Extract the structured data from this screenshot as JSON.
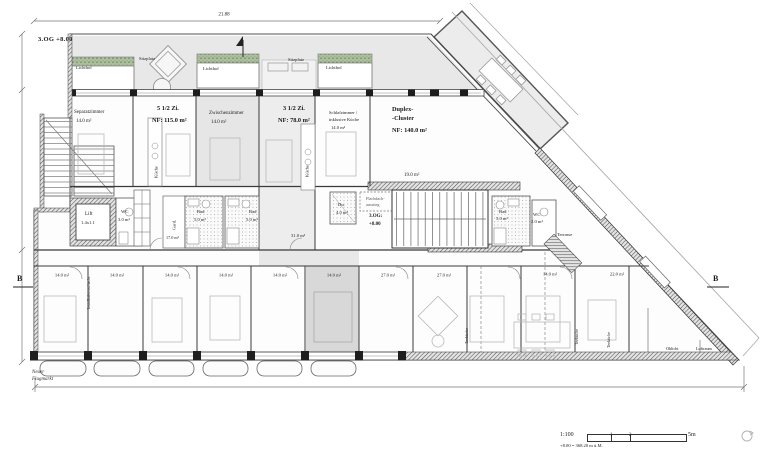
{
  "header": {
    "floor_label": "3.OG  +8.00"
  },
  "dimensions": {
    "top_width": "21.88"
  },
  "section_markers": {
    "left": "B",
    "right": "B"
  },
  "street": {
    "line1": "Neuer",
    "line2": "Flugmarkt"
  },
  "apartments": [
    {
      "name": "5 1/2 Zi.",
      "area": "NF: 115.0 m²"
    },
    {
      "name": "3 1/2 Zi.",
      "area": "NF: 78.0 m²"
    },
    {
      "name_line1": "Duplex-",
      "name_line2": "-Cluster",
      "area": "NF: 140.0 m²"
    }
  ],
  "rooms": {
    "separatzimmer": {
      "name": "Separatzimmer",
      "area": "14.0 m²"
    },
    "zwischenzimmer": {
      "name": "Zwischenzimmer",
      "area": "14.0 m²"
    },
    "schlafzimmer": {
      "name_line1": "Schlafzimmer /",
      "name_line2": "inklusive Küche",
      "area": "14.0 m²"
    },
    "room_19": {
      "area": "19.0 m²"
    },
    "hall_31": {
      "area": "31.0 m²"
    },
    "gard": {
      "name": "Gard.",
      "area": "17.0 m²"
    },
    "lift": {
      "name": "Lift",
      "size": "1.4x1.1"
    },
    "wc_left": {
      "name": "WC",
      "area": "3.0 m²"
    },
    "bad_left": {
      "name": "Bad",
      "area": "5.0 m²"
    },
    "bad_mid": {
      "name": "Bad",
      "area": "5.0 m²"
    },
    "du": {
      "name": "Du.",
      "area": "4.0 m²"
    },
    "bad_right": {
      "name": "Bad",
      "area": "5.0 m²"
    },
    "wc_right": {
      "name": "WC",
      "area": "2.0 m²"
    },
    "kueche": "Küche",
    "terrasse": "Terrasse",
    "lichthof": "Lichthof",
    "sitzplatz": "Sitzplatz",
    "teekueche": "Teeküche",
    "installation": "Installationsschacht",
    "oblicht": "Oblicht",
    "luftraum": "Luftraum",
    "stairwell": {
      "exit_line1": "Flachdach-",
      "exit_line2": "ausstieg",
      "level_line1": "3.OG:",
      "level_line2": "+8.00"
    }
  },
  "bottom_rooms": [
    "14.0 m²",
    "14.0 m²",
    "14.0 m²",
    "14.0 m²",
    "14.0 m²",
    "14.0 m²",
    "27.0 m²",
    "27.0 m²",
    "14.0 m²",
    "22.0 m²"
  ],
  "scale_bar": {
    "ratio": "1:100",
    "tick_1": "1",
    "tick_2": "2",
    "tick_end": "5m",
    "elevation_note": "+8.00 = 368.20 m ü.M."
  },
  "colors": {
    "line_dark": "#2a2a2a",
    "line_mid": "#777777",
    "roof_gray": "#e8e8e8",
    "highlight_gray": "#d8d8d8",
    "planting_green": "#8fa77e",
    "paper": "#ffffff"
  }
}
